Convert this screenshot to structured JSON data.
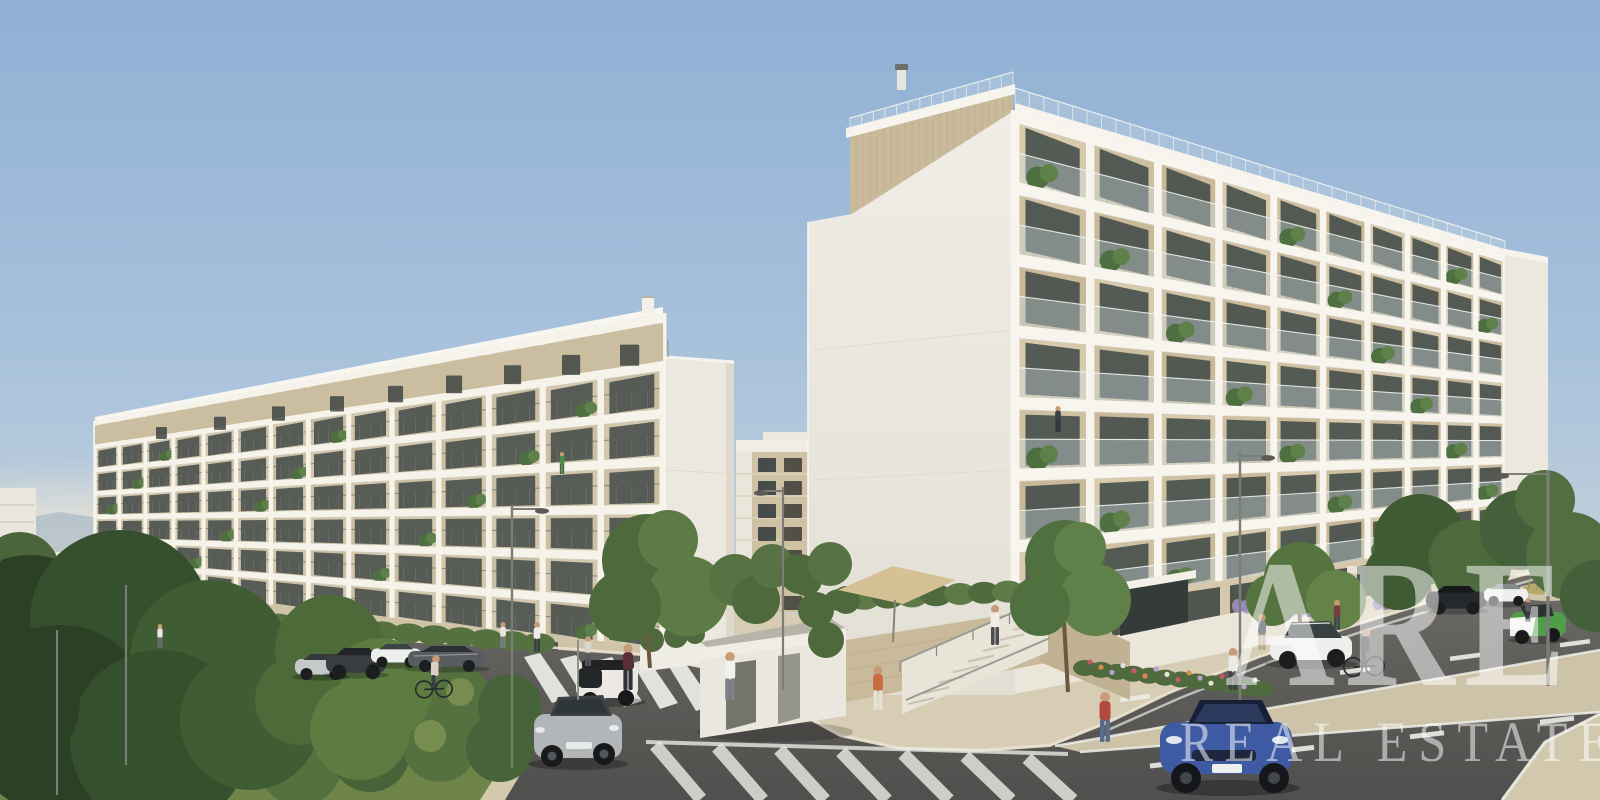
{
  "image_type": "3D architectural rendering (real estate exterior visualization)",
  "watermark": {
    "line1": "ARE",
    "line2": "REAL ESTATE",
    "color": "#ffffff",
    "opacity": 0.52
  },
  "scene": {
    "description": "Two modern white mid-rise apartment buildings with stacked balconies under a clear blue sky; street corner with roundabout island, zebra crossing, parked and driving cars, cyclists and pedestrians, landscaped beds and young trees.",
    "buildings": [
      "left apartment block with seven balcony floors and setback travertine penthouse",
      "right apartment block with blank gable wall, seven balcony floors and rooftop timber penthouse",
      "beige background apartment tower in the gap between blocks",
      "small white garage pavilion with flat roof",
      "travertine retaining walls with entrance staircase"
    ],
    "vehicles": [
      "blue SUV coupe driving toward viewer",
      "silver hatchback driving near crossing",
      "white Audi sedan on right street",
      "black electric SUV",
      "white compact SUV",
      "green and white microcar",
      "white city car with black rear parked",
      "dark gray sedan driving on left street",
      "row of parked cars: silver hatchback, dark SUV, white hatchback"
    ],
    "people": [
      "two cyclists",
      "woman in orange top near stairs",
      "person climbing entrance stairs",
      "pedestrians on sidewalks",
      "resident standing on balcony"
    ],
    "road_features": [
      "zebra crosswalk",
      "white hatched gore markings",
      "dashed lane lines",
      "tapering beige median strip",
      "roundabout give-way dashes",
      "street lamps"
    ],
    "landscape": [
      "planted roundabout island with shrubs and large trees",
      "lavender strip",
      "mixed flower beds",
      "hedges over retaining wall",
      "tan parasol"
    ]
  },
  "palette": {
    "sky_top": "#8fb0d4",
    "sky_mid": "#a9c2dc",
    "sky_horizon": "#e7e2d2",
    "building_white": "#efece4",
    "slab_white": "#f7f5ee",
    "travertine": "#d3c6a8",
    "window_glass": "#49504c",
    "wood_cladding": "#c9ba9c",
    "asphalt": "#5e5d5a",
    "road_marking": "#eceee7",
    "sidewalk": "#d7cdb4",
    "tree_dark": "#31482a",
    "tree_mid": "#4d6a3a",
    "tree_light": "#6d8a4b",
    "car_blue": "#3d5aa3",
    "car_green": "#4f9d49",
    "lavender": "#9d8fc0",
    "watermark_white": "#ffffff"
  }
}
